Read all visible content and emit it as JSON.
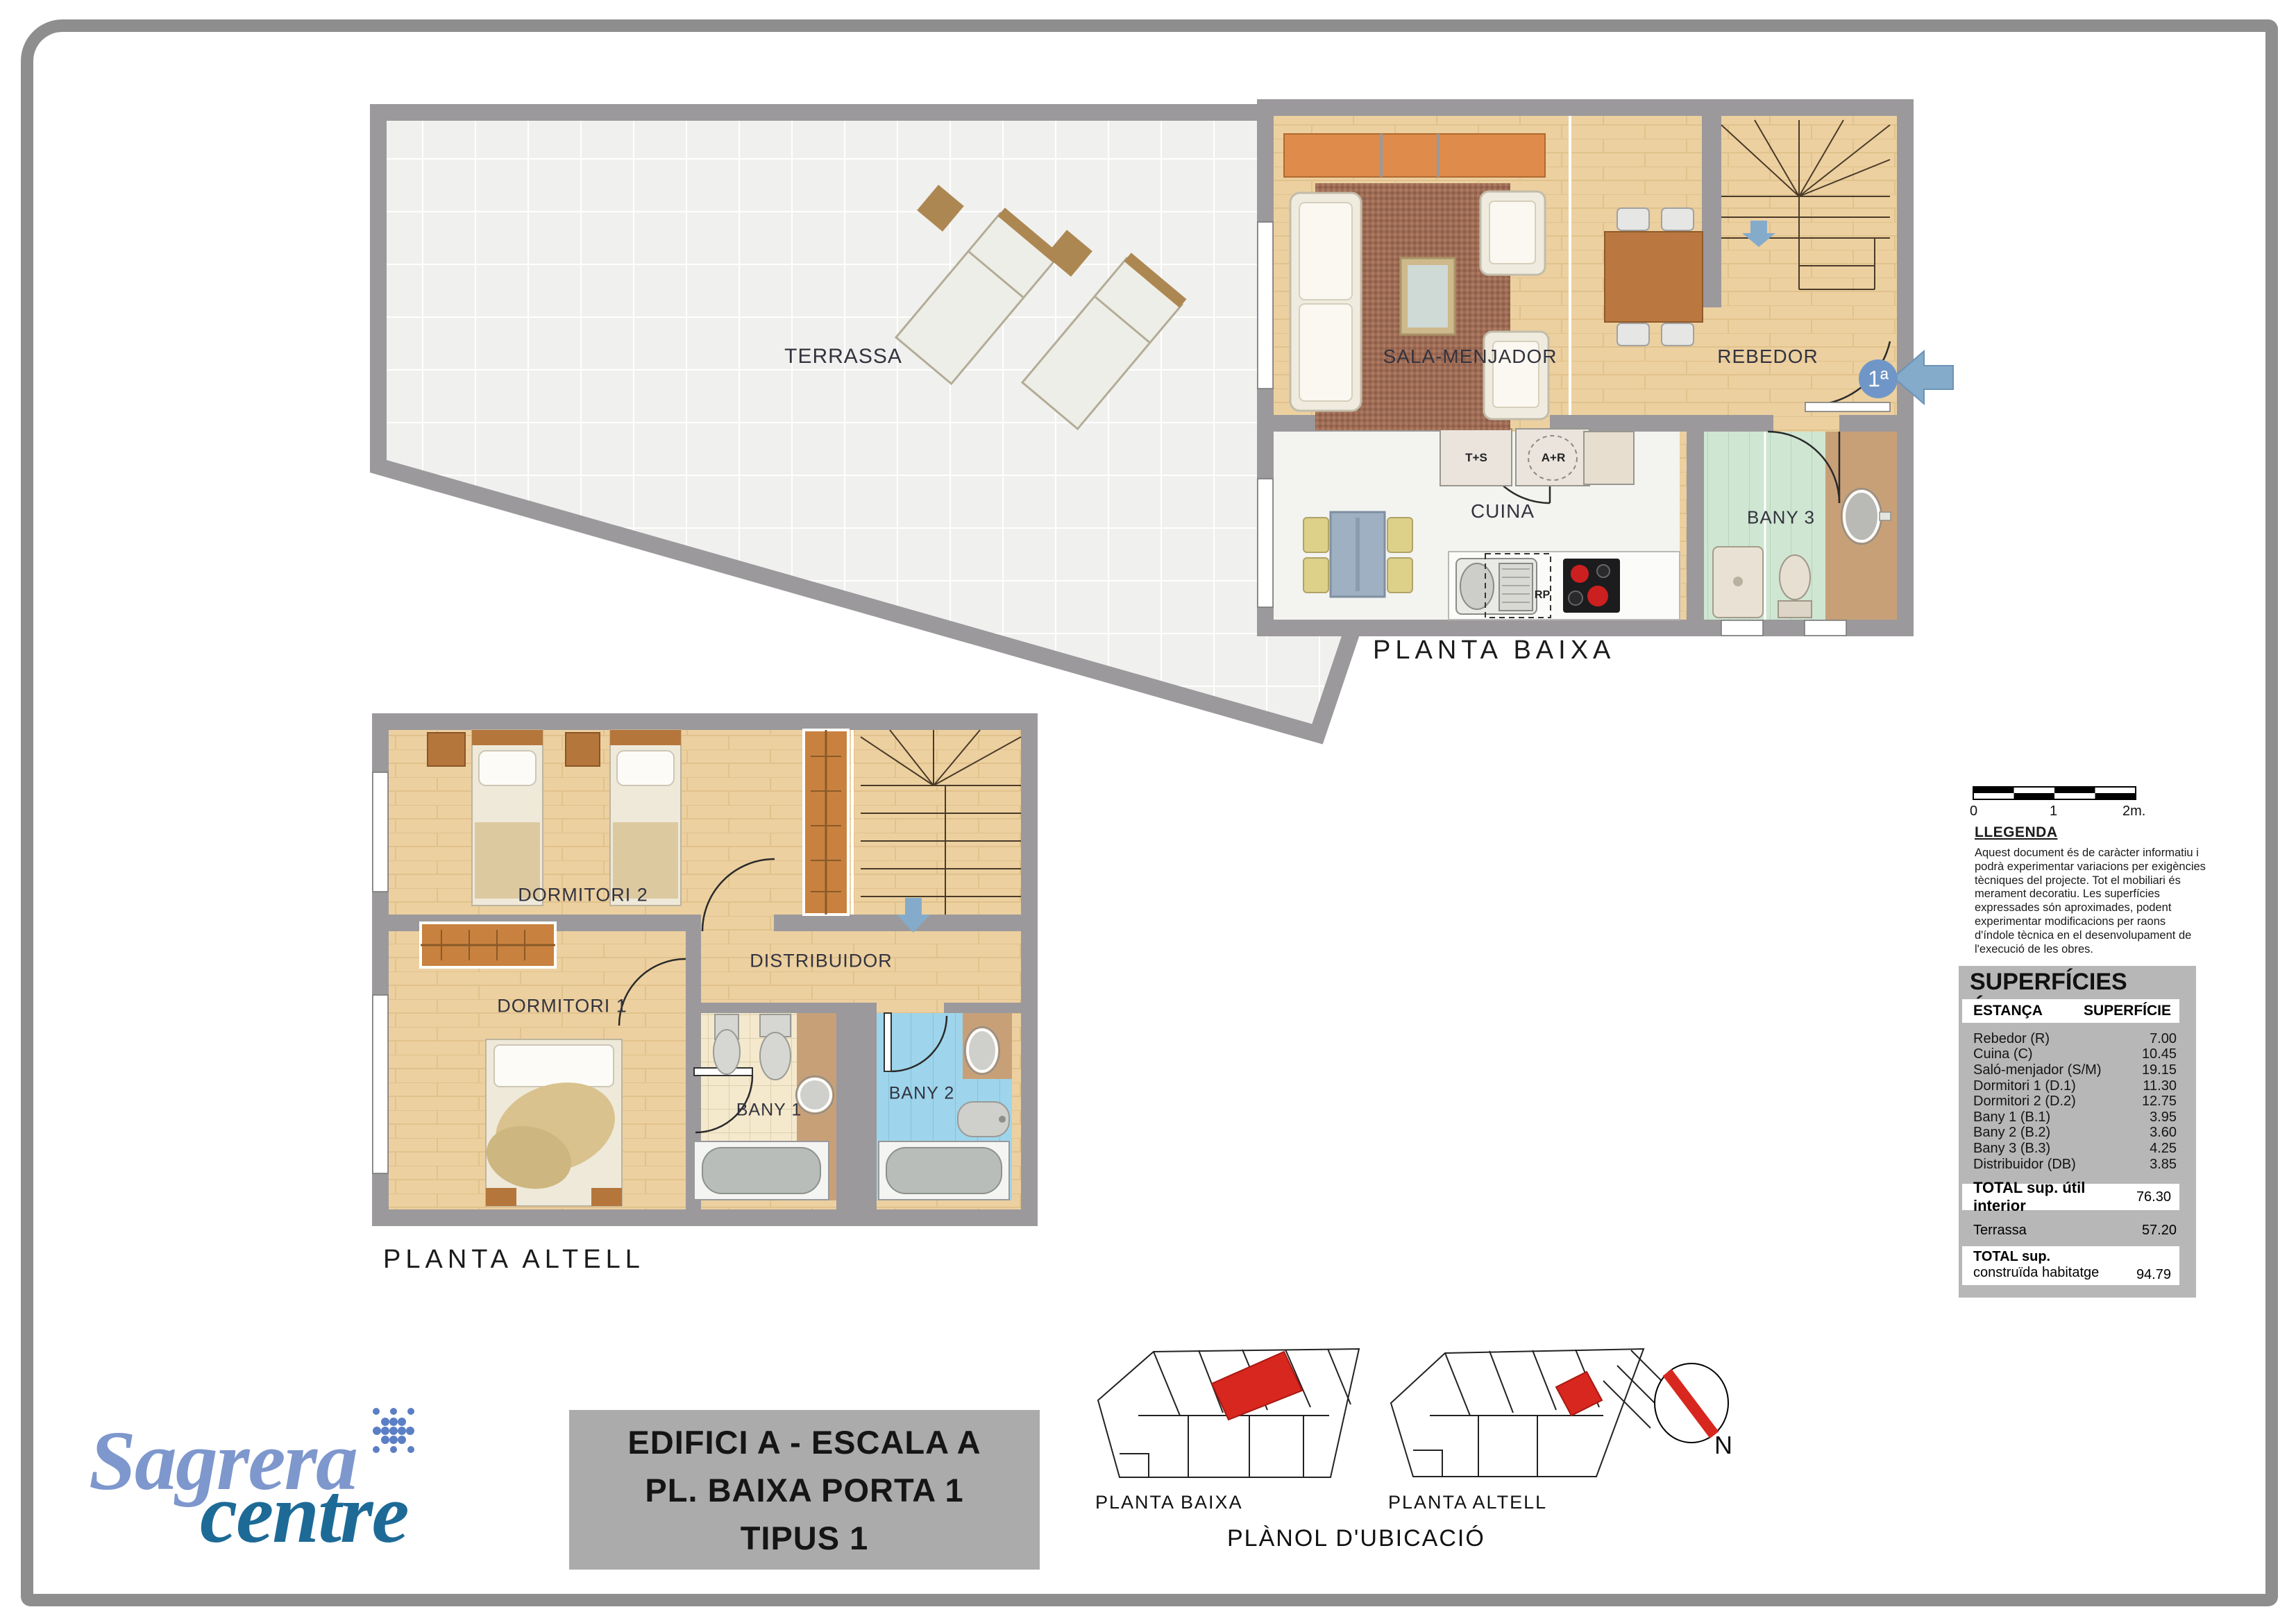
{
  "plans": {
    "planta_baixa": {
      "caption": "PLANTA BAIXA",
      "rooms": {
        "terrassa": "TERRASSA",
        "sala": "SALA-MENJADOR",
        "rebedor": "REBEDOR",
        "cuina": "CUINA",
        "bany3": "BANY 3"
      },
      "appliances": {
        "ts": "T+S",
        "ar": "A+R",
        "rp": "RP"
      },
      "entry_badge": "1ª"
    },
    "planta_altell": {
      "caption": "PLANTA ALTELL",
      "rooms": {
        "dormitori2": "DORMITORI 2",
        "dormitori1": "DORMITORI 1",
        "distribuidor": "DISTRIBUIDOR",
        "bany1": "BANY 1",
        "bany2": "BANY 2"
      }
    }
  },
  "scalebar": {
    "t0": "0",
    "t1": "1",
    "t2": "2m."
  },
  "legend": {
    "title": "LLEGENDA",
    "body": "Aquest document és de caràcter informatiu i podrà experimentar variacions per exigències tècniques del projecte. Tot el mobiliari és merament decoratiu. Les superfícies expressades són aproximades, podent experimentar modificacions per raons d'índole tècnica en el desenvolupament de l'execució de les obres."
  },
  "areas_table": {
    "title": "SUPERFÍCIES ÚTILS",
    "col_room": "ESTANÇA",
    "col_area": "SUPERFÍCIE",
    "rows": [
      {
        "label": "Rebedor (R)",
        "value": "7.00"
      },
      {
        "label": "Cuina (C)",
        "value": "10.45"
      },
      {
        "label": "Saló-menjador (S/M)",
        "value": "19.15"
      },
      {
        "label": "Dormitori 1 (D.1)",
        "value": "11.30"
      },
      {
        "label": "Dormitori 2 (D.2)",
        "value": "12.75"
      },
      {
        "label": "Bany 1 (B.1)",
        "value": "3.95"
      },
      {
        "label": "Bany 2 (B.2)",
        "value": "3.60"
      },
      {
        "label": "Bany 3 (B.3)",
        "value": "4.25"
      },
      {
        "label": "Distribuidor (DB)",
        "value": "3.85"
      }
    ],
    "total_interior_label": "TOTAL sup. útil interior",
    "total_interior_value": "76.30",
    "terrassa_label": "Terrassa",
    "terrassa_value": "57.20",
    "total_built_label1": "TOTAL sup.",
    "total_built_label2": "construïda habitatge",
    "total_built_value": "94.79"
  },
  "title_block": {
    "line1": "EDIFICI A - ESCALA A",
    "line2": "PL. BAIXA PORTA 1",
    "line3": "TIPUS 1"
  },
  "logo": {
    "word1": "Sagrera",
    "word2": "centre"
  },
  "location": {
    "plan1_label": "PLANTA BAIXA",
    "plan2_label": "PLANTA ALTELL",
    "caption": "PLÀNOL D'UBICACIÓ",
    "north_label": "N"
  },
  "colors": {
    "accent_red": "#d8271e",
    "logo_light_blue": "#7e97cd",
    "logo_dark_blue": "#1d6a97",
    "logo_dots_blue": "#5b7fc4",
    "arrow_blue": "#85abcb",
    "wall_gray": "#9b999b",
    "wood_floor": "#ecd0a0",
    "terrace_tile": "#f0f0ee",
    "bany3_green": "#cfe6d2",
    "bany2_blue": "#9ed5ec",
    "bany1_cream": "#f4e9cd",
    "title_box_gray": "#ababab",
    "table_panel_gray": "#b7b7b7"
  }
}
